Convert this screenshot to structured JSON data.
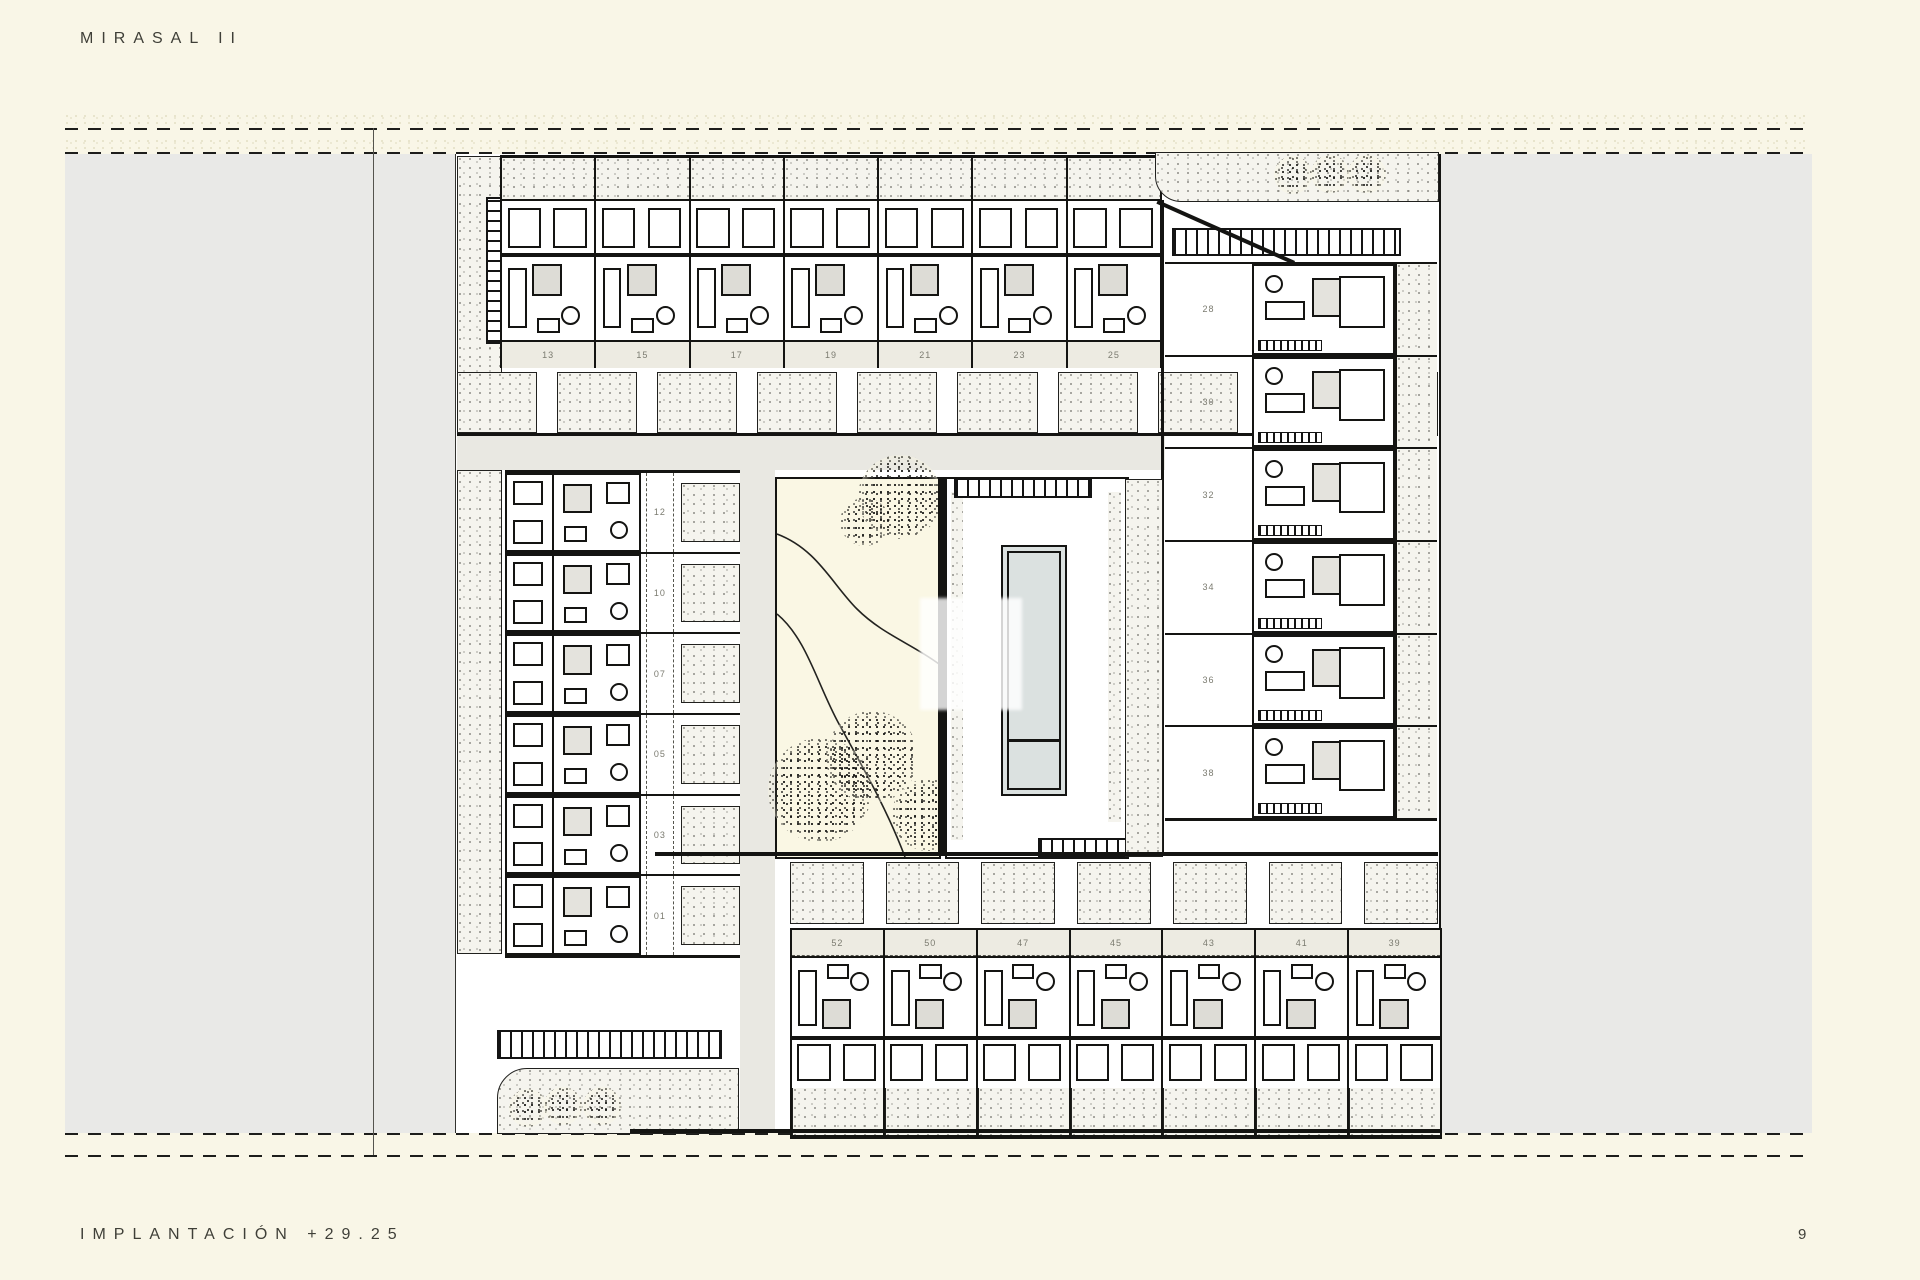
{
  "page": {
    "title": "MIRASAL II",
    "footer_left": "IMPLANTACIÓN +29.25",
    "page_number": "9"
  },
  "colors": {
    "paper": "#f9f6e7",
    "gray": "#e9e9e7",
    "stipple-bg": "#f5f4ee",
    "band": "#edebe2",
    "label-ink": "#7b7b70",
    "ink": "#3f3f38",
    "court": "#faf7e4",
    "water": "#dbe1e0",
    "road": "#e9e8e2"
  },
  "plan": {
    "top_row_units": [
      "13",
      "15",
      "17",
      "19",
      "21",
      "23",
      "25"
    ],
    "left_column_units": [
      "12",
      "10",
      "07",
      "05",
      "03",
      "01"
    ],
    "right_column_units": [
      "28",
      "30",
      "32",
      "34",
      "36",
      "38"
    ],
    "bottom_row_units": [
      "52",
      "50",
      "47",
      "45",
      "43",
      "41",
      "39"
    ]
  }
}
